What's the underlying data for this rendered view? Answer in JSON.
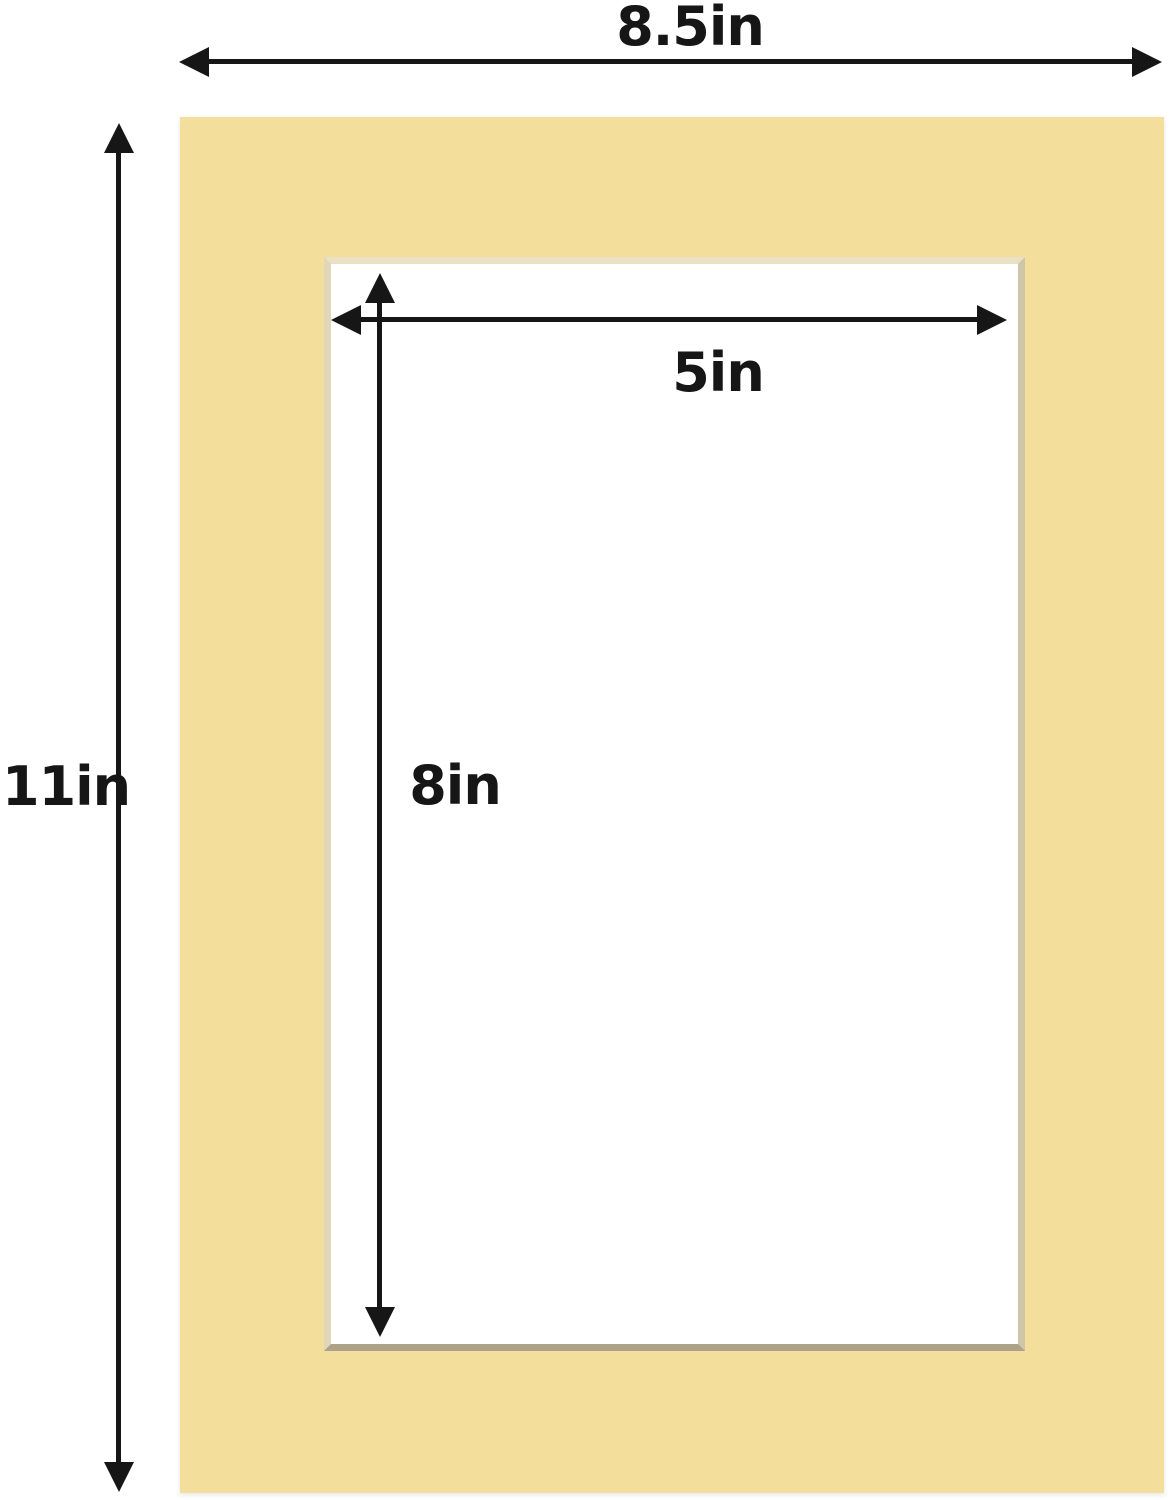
{
  "diagram": {
    "type": "product-dimension-diagram",
    "subject": "picture frame mat board with beveled opening",
    "dimensions": {
      "outer_width": {
        "label": "8.5in"
      },
      "outer_height": {
        "label": "11in"
      },
      "opening_width": {
        "label": "5in"
      },
      "opening_height": {
        "label": "8in"
      }
    },
    "colors": {
      "background": "#FFFFFF",
      "mat": "#F3DE9C",
      "bevel_top": "#EAE1C5",
      "bevel_left": "#E0D6B8",
      "bevel_right": "#CFC5A8",
      "bevel_bottom": "#ACA38A",
      "arrow": "#161616",
      "text": "#161616"
    }
  }
}
